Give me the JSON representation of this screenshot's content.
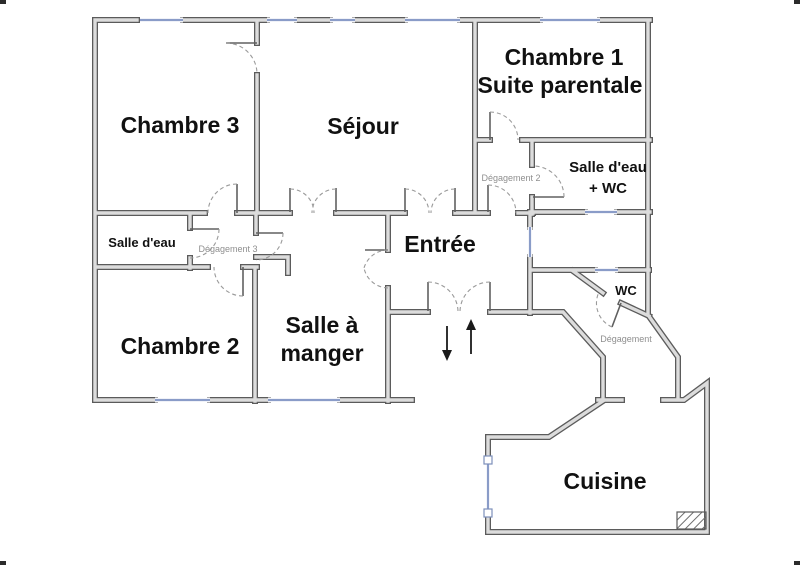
{
  "title": "Plan d'appartement",
  "rooms": {
    "chambre3": "Chambre 3",
    "sejour": "Séjour",
    "chambre1_line1": "Chambre 1",
    "chambre1_line2": "Suite parentale",
    "salle_eau_wc_line1": "Salle d'eau",
    "salle_eau_wc_line2": "+ WC",
    "degagement2": "Dégagement 2",
    "salle_eau": "Salle d'eau",
    "degagement3": "Dégagement 3",
    "entree": "Entrée",
    "chambre2": "Chambre 2",
    "salle_a_manger_line1": "Salle à",
    "salle_a_manger_line2": "manger",
    "wc": "WC",
    "degagement": "Dégagement",
    "cuisine": "Cuisine"
  },
  "colors": {
    "wall_outline": "#5b5b5b",
    "wall_fill": "#dcdcdc",
    "window": "#8a9cc8",
    "door_leaf": "#606060",
    "door_arc": "#9a9a9a",
    "label": "#111111",
    "label_small": "#8f8f8f",
    "arrow": "#1a1a1a",
    "hatch": "#6e6e6e"
  }
}
